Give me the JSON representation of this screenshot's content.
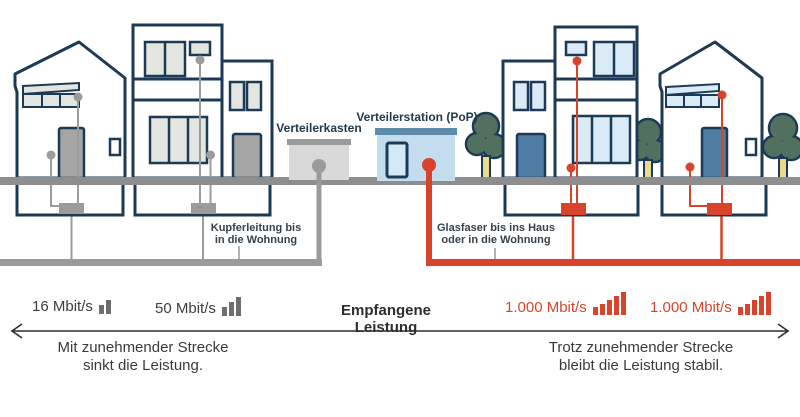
{
  "left": {
    "box_label": "Verteilerkasten",
    "cable_label": {
      "line1": "Kupferleitung bis",
      "line2": "in die Wohnung"
    },
    "speed1": {
      "label": "16 Mbit/s"
    },
    "speed2": {
      "label": "50 Mbit/s"
    },
    "caption": {
      "line1": "Mit zunehmender Strecke",
      "line2": "sinkt die Leistung."
    }
  },
  "center": {
    "label": "Empfangene Leistung"
  },
  "right": {
    "station_label": "Verteilerstation (PoP)",
    "cable_label": {
      "line1": "Glasfaser bis ins Haus",
      "line2": "oder in die Wohnung"
    },
    "speed1": {
      "label": "1.000 Mbit/s"
    },
    "speed2": {
      "label": "1.000 Mbit/s"
    },
    "caption": {
      "line1": "Trotz zunehmender Strecke",
      "line2": "bleibt die Leistung stabil."
    }
  },
  "icons": {
    "signal_2_bars": [
      9,
      14
    ],
    "signal_3_bars": [
      9,
      14,
      19
    ],
    "signal_5_bars_a": [
      8,
      11,
      15,
      19,
      23
    ],
    "signal_5_bars_b": [
      8,
      11,
      15,
      19,
      23
    ]
  },
  "colors": {
    "copper": "#9b9b9b",
    "fiber": "#d8432b",
    "outline": "#1c3a55",
    "street": "#8e8e8e",
    "pop_fill": "#c4ddee",
    "pop_roof": "#5d8cab",
    "tree": "#51705f"
  }
}
